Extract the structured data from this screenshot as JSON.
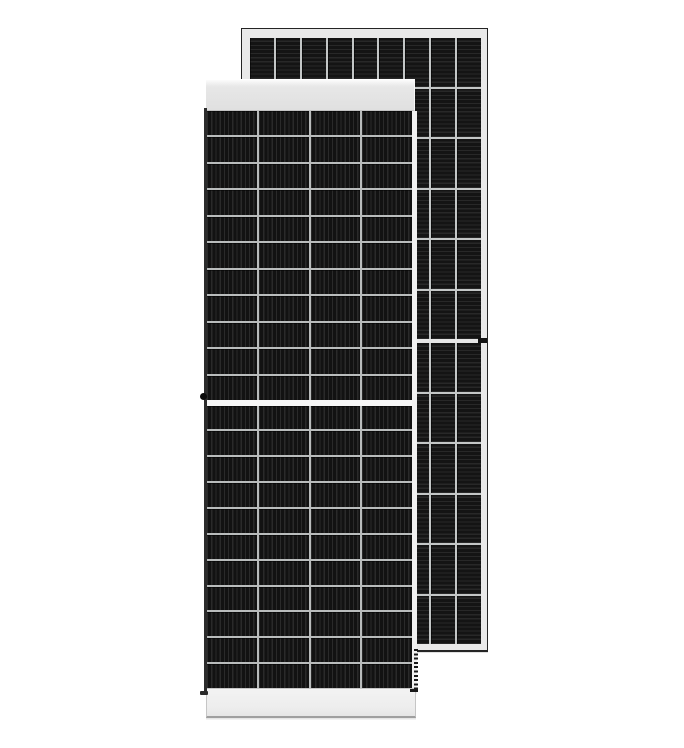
{
  "image": {
    "description": "Product photo of two frameless-looking black monocrystalline solar PV modules on a white background: a front module in portrait orientation with a light top and bottom rail overlapping a taller rear module shown behind and to the right",
    "background_color": "#ffffff"
  },
  "colors": {
    "scene_bg": "#ffffff",
    "front_cell_base": "#121212",
    "front_cell_stripe": "#2a2a2a",
    "front_grid_line": "#b9bcbc",
    "front_mid_band": "#f6f6f6",
    "front_top_band": "#e0e0e0",
    "front_top_band_light": "#fbfbfb",
    "front_bottom_band": "#ededed",
    "front_edge_dark": "#2c2c2c",
    "front_frame_light": "#f1f1f1",
    "rear_cell_base": "#141414",
    "rear_cell_stripe": "#282828",
    "rear_grid_line": "#c3c6c6",
    "rear_frame": "#e9e9e9",
    "rear_edge_dark": "#242424",
    "rear_mid_gap": "#e6e6e6",
    "dot_color": "#0b0b0b",
    "notch_color": "#121212",
    "dash_color": "#1a1a1a",
    "shadow_line": "#9f9f9f"
  },
  "panels": {
    "front": {
      "label": "front solar module",
      "columns": 4,
      "rows_per_half": 11,
      "halves": 2,
      "stripe_direction": "vertical",
      "features": [
        "light gray top rail",
        "light gray bottom rail",
        "white center busbar gap",
        "black grounding dot on left frame",
        "dashed frame edge lower right"
      ]
    },
    "rear": {
      "label": "rear solar module",
      "columns": 9,
      "rows_per_half": 6,
      "halves": 2,
      "stripe_direction": "horizontal",
      "features": [
        "light aluminum frame with dark outline",
        "center gap between halves",
        "dark mounting notch on right frame"
      ]
    }
  }
}
